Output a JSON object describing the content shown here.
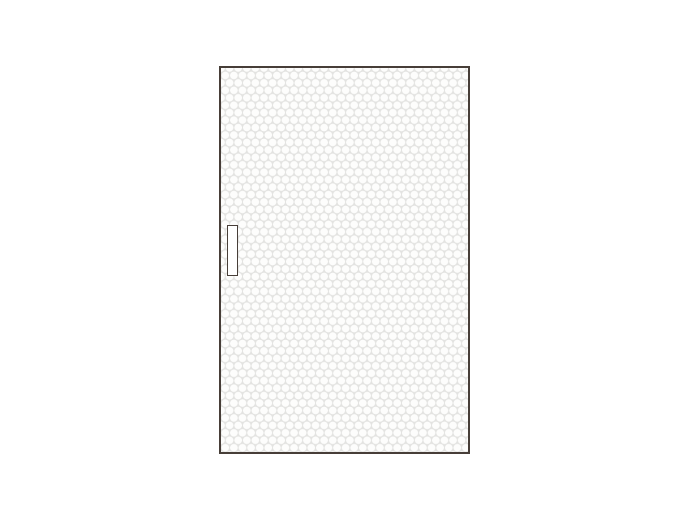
{
  "shapes": {
    "door": "door-panel-with-hex-dot-texture",
    "handle": "vertical-door-handle-left-middle"
  },
  "colors": {
    "page_bg": "#ffffff",
    "door_frame": "#473e38",
    "pattern_bg": "#e3e3e1",
    "pattern_dot": "#fdfdfc",
    "handle_border": "#473e38",
    "handle_fill": "#ffffff"
  }
}
